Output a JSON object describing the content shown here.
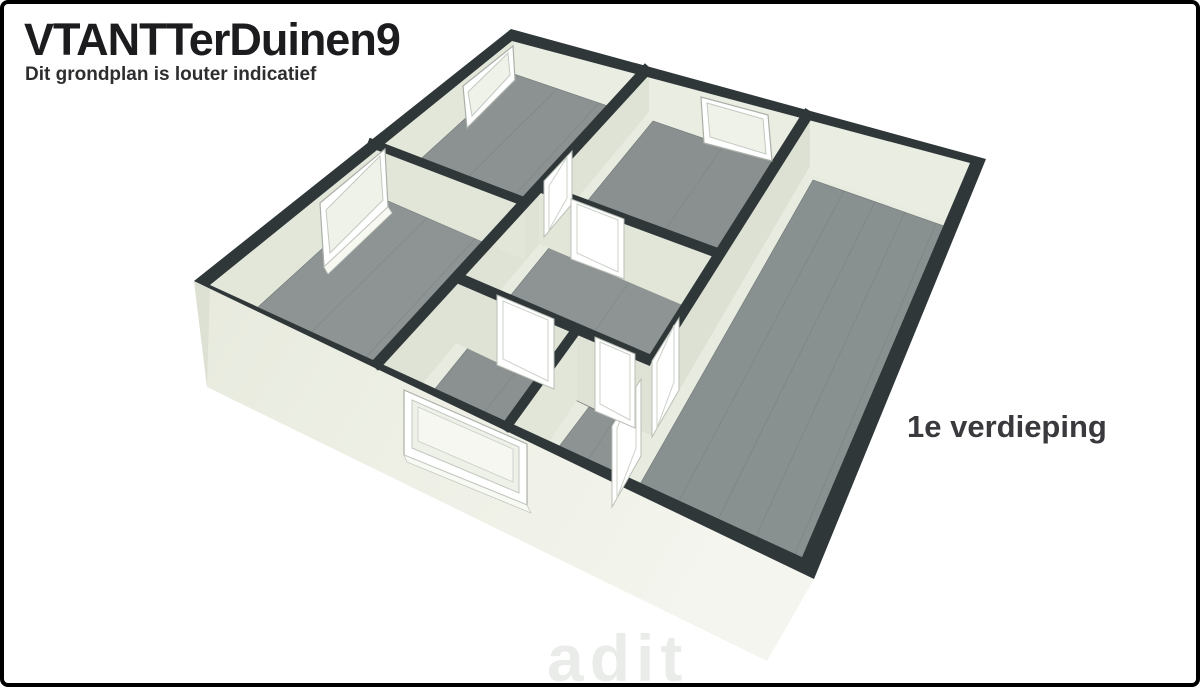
{
  "header": {
    "title": "VTANTTerDuinen9",
    "subtitle": "Dit grondplan is louter indicatief"
  },
  "floor_label": "1e verdieping",
  "watermark": "adit",
  "floorplan": {
    "type": "3d-floorplan-isometric",
    "visible_rooms": 7,
    "visible_windows": 4,
    "visible_door_frames": 6,
    "colors": {
      "wall_cap": "#2f3739",
      "exterior_wall_light": "#f3f5ee",
      "exterior_wall_shade": "#e7eadd",
      "interior_wall": "#e8ebdf",
      "interior_wall_shade": "#dfe3d6",
      "floor_wood": "#8c9292",
      "floor_plank_line": "#6e7676",
      "window_frame": "#ffffff",
      "page_background": "#ffffff",
      "page_border": "#000000",
      "title_text": "#1c1c1e",
      "label_text": "#3a3a3e"
    }
  }
}
